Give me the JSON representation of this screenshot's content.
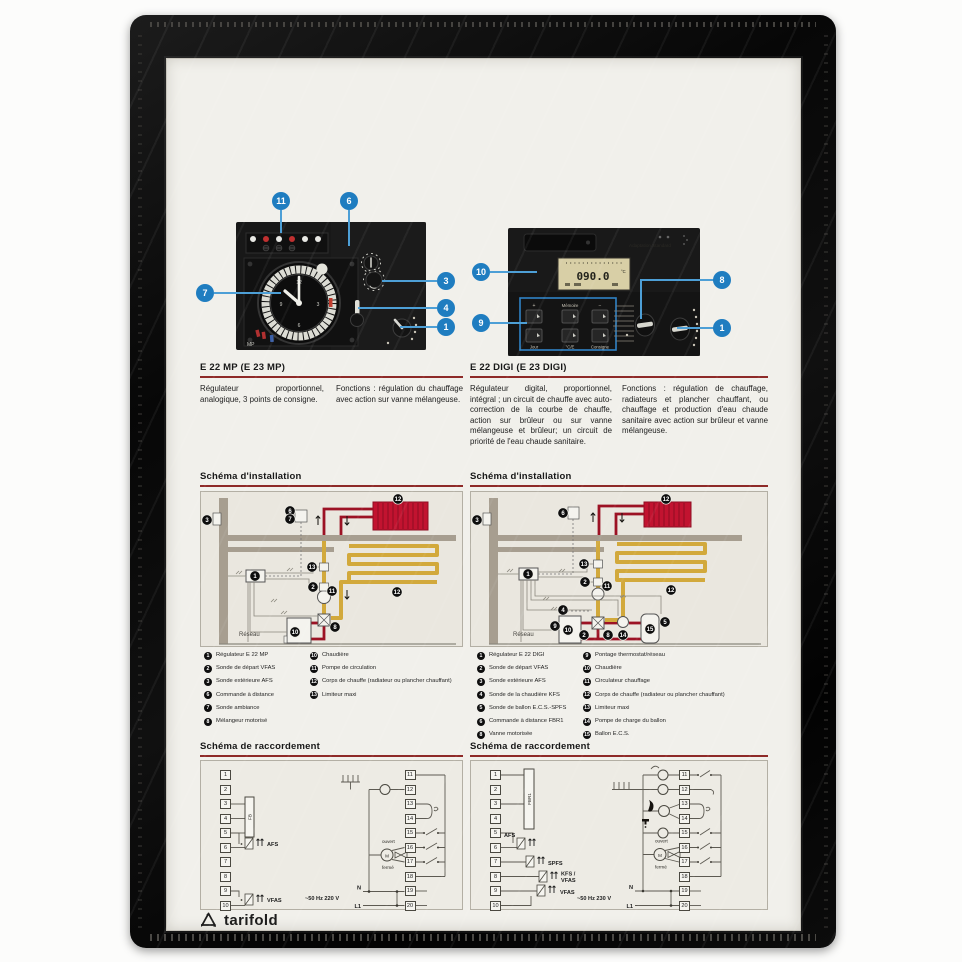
{
  "frame": {
    "brand": "tarifold"
  },
  "products": {
    "left": {
      "title": "E 22 MP  (E 23 MP)",
      "description": "Régulateur proportionnel, analogique, 3 points de consigne.",
      "functions": "Fonctions : régulation du chauffage avec action sur vanne mélangeuse.",
      "panel_mark": "MP"
    },
    "right": {
      "title": "E 22 DIGI  (E 23 DIGI)",
      "description": "Régulateur digital, proportionnel, intégral ; un circuit de chauffe avec auto-correction de la courbe de chauffe, action sur brûleur ou sur vanne mélangeuse et brûleur; un circuit de priorité de l'eau chaude sanitaire.",
      "functions": "Fonctions : régulation de chauffage, radiateurs et plancher chauffant, ou chauffage et production d'eau chaude sanitaire avec action sur brûleur et vanne mélangeuse.",
      "lcd_value": "090.0",
      "lcd_unit": "°C",
      "panel_text": "Adaptation Standard",
      "keypad": {
        "plus": "+",
        "memoire": "Mémoire",
        "minus": "−",
        "jour": "Jour",
        "mode": "°C/E",
        "consigne": "Consigne"
      }
    }
  },
  "callouts": [
    "11",
    "6",
    "7",
    "3",
    "4",
    "1",
    "10",
    "9",
    "8",
    "1"
  ],
  "sections": {
    "installation": "Schéma d'installation",
    "raccordement": "Schéma de raccordement"
  },
  "install_left": {
    "reseau": "Réseau",
    "markers": [
      "3",
      "6",
      "7",
      "1",
      "13",
      "2",
      "11",
      "12",
      "12",
      "10",
      "8"
    ],
    "legend_col1": [
      {
        "n": "1",
        "label": "Régulateur E 22 MP"
      },
      {
        "n": "2",
        "label": "Sonde de départ VFAS"
      },
      {
        "n": "3",
        "label": "Sonde extérieure AFS"
      },
      {
        "n": "6",
        "label": "Commande à distance"
      },
      {
        "n": "7",
        "label": "Sonde ambiance"
      },
      {
        "n": "8",
        "label": "Mélangeur motorisé"
      }
    ],
    "legend_col2": [
      {
        "n": "10",
        "label": "Chaudière"
      },
      {
        "n": "11",
        "label": "Pompe de circulation"
      },
      {
        "n": "12",
        "label": "Corps de chauffe (radiateur ou plancher chauffant)"
      },
      {
        "n": "13",
        "label": "Limiteur maxi"
      }
    ]
  },
  "install_right": {
    "reseau": "Réseau",
    "markers": [
      "3",
      "6",
      "1",
      "13",
      "2",
      "11",
      "12",
      "12",
      "4",
      "9",
      "10",
      "2",
      "8",
      "14",
      "15",
      "5"
    ],
    "legend_col1": [
      {
        "n": "1",
        "label": "Régulateur E 22 DIGI"
      },
      {
        "n": "2",
        "label": "Sonde de départ VFAS"
      },
      {
        "n": "3",
        "label": "Sonde extérieure AFS"
      },
      {
        "n": "4",
        "label": "Sonde de la chaudière KFS"
      },
      {
        "n": "5",
        "label": "Sonde de ballon E.C.S.-SPFS"
      },
      {
        "n": "6",
        "label": "Commande à distance FBR1"
      },
      {
        "n": "8",
        "label": "Vanne motorisée"
      }
    ],
    "legend_col2": [
      {
        "n": "9",
        "label": "Pontage thermostat/réseau"
      },
      {
        "n": "10",
        "label": "Chaudière"
      },
      {
        "n": "11",
        "label": "Circulateur chauffage"
      },
      {
        "n": "12",
        "label": "Corps de chauffe (radiateur ou plancher chauffant)"
      },
      {
        "n": "13",
        "label": "Limiteur maxi"
      },
      {
        "n": "14",
        "label": "Pompe de charge du ballon"
      },
      {
        "n": "15",
        "label": "Ballon E.C.S."
      }
    ]
  },
  "wiring_left": {
    "terminals_left": [
      "1",
      "2",
      "3",
      "4",
      "5",
      "6",
      "7",
      "8",
      "9",
      "10"
    ],
    "terminals_right": [
      "11",
      "12",
      "13",
      "14",
      "15",
      "16",
      "17",
      "18",
      "19",
      "20"
    ],
    "labels": {
      "fb": "FB",
      "afs": "AFS",
      "vfas": "VFAS",
      "supply": "~50 Hz 220 V",
      "n": "N",
      "l1": "L1",
      "ouvert": "ouvert",
      "ferme": "fermé",
      "motor": "M"
    }
  },
  "wiring_right": {
    "terminals_left": [
      "1",
      "2",
      "3",
      "4",
      "5",
      "6",
      "7",
      "8",
      "9",
      "10"
    ],
    "terminals_right": [
      "11",
      "12",
      "13",
      "14",
      "15",
      "16",
      "17",
      "18",
      "19",
      "20"
    ],
    "labels": {
      "fbr": "FBR1",
      "afs": "AFS",
      "spfs": "SPFS",
      "kfs": "KFS /",
      "kfs2": "VFAS",
      "vfas": "VFAS",
      "supply": "~50 Hz 230 V",
      "n": "N",
      "l1": "L1",
      "ouvert": "ouvert",
      "ferme": "fermé",
      "motor": "M"
    }
  }
}
